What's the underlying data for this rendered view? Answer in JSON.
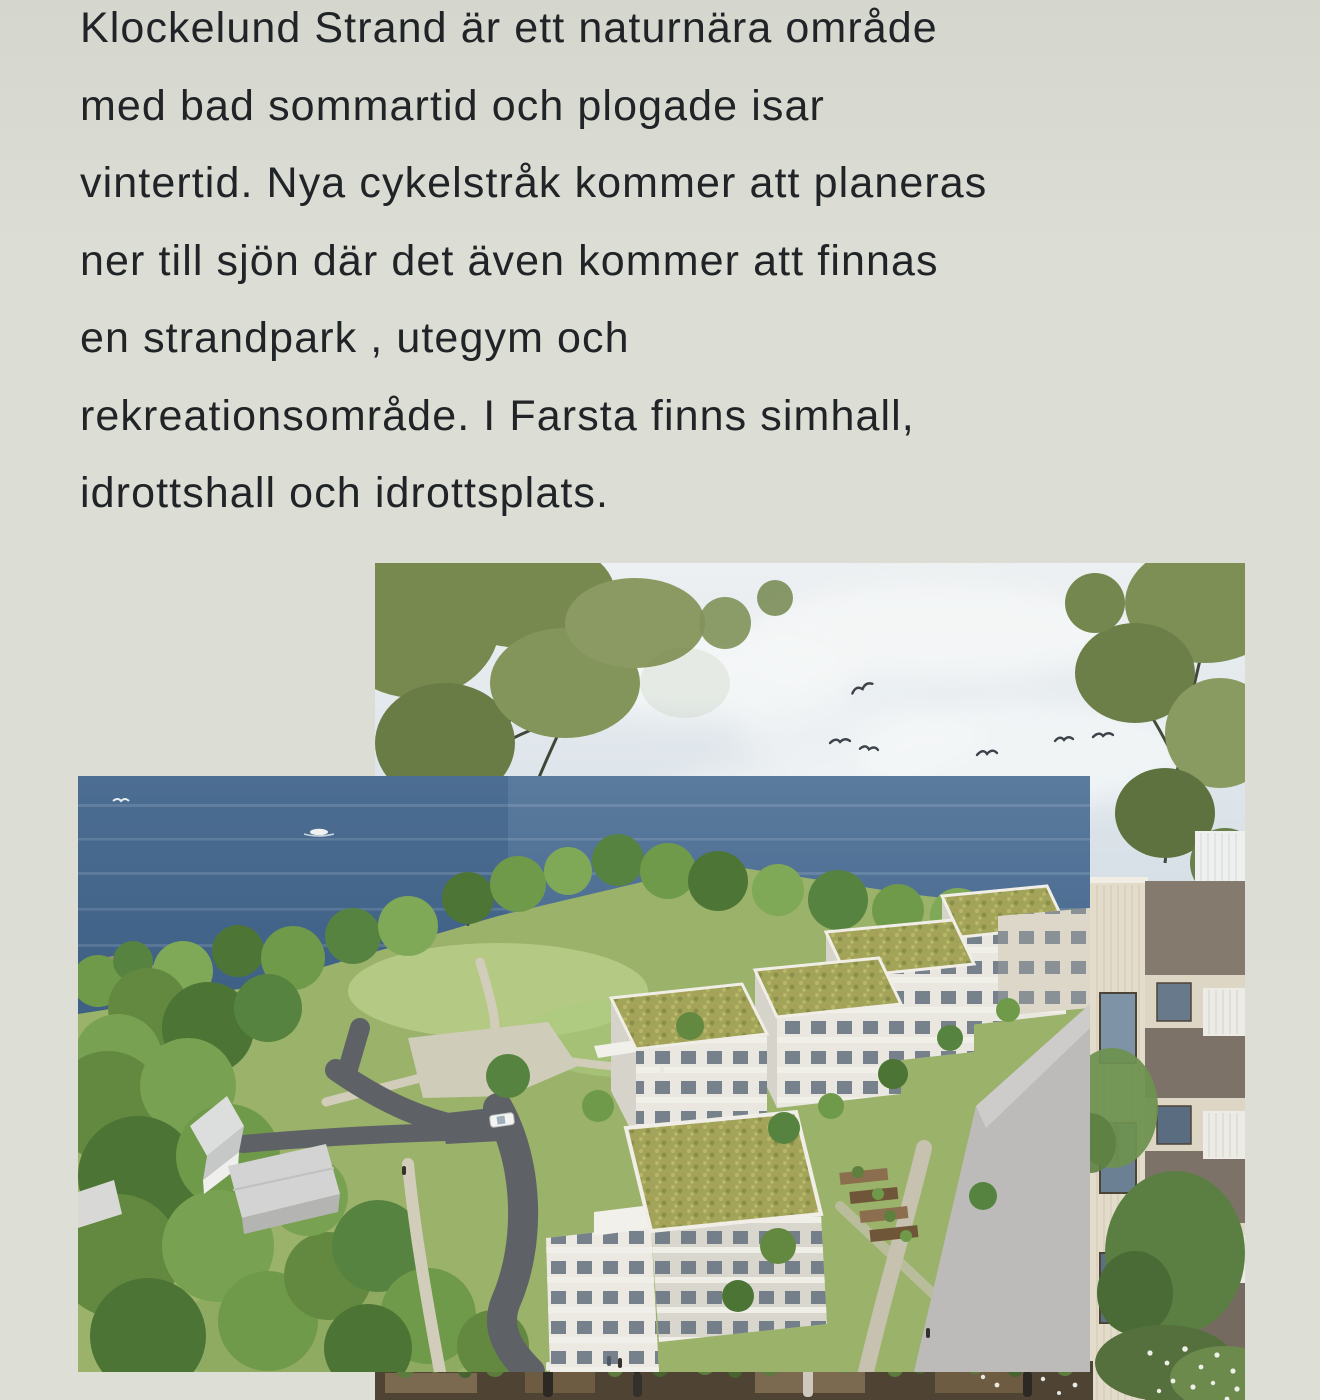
{
  "article": {
    "lines": [
      "Klockelund Strand är ett naturnära område",
      "med bad sommartid och plogade isar",
      "vintertid. Nya cykelstråk kommer att planeras",
      "ner till sjön där det även kommer att finnas",
      "en strandpark , utegym och",
      "rekreationsområde. I Farsta finns simhall,",
      "idrottshall och idrottsplats."
    ]
  },
  "images": {
    "hero": {
      "alt": "Rendering: trees and sky with birds over a lake, close-up of a timber-clad apartment facade with balconies and a planted terrace"
    },
    "aerial": {
      "alt": "Aerial rendering: lakefront park with shoreline trees, paths, roads and white apartment blocks with green sedum roofs"
    }
  },
  "palette": {
    "page_background": "#dcded6",
    "text_color": "#212427",
    "water": "#4e6f93",
    "foliage": "#6f9a49",
    "grass": "#9ab269",
    "sedum_roof": "#a2a45a",
    "facade_white": "#e9e7e0",
    "facade_cream": "#e3dccb",
    "facade_taupe": "#80756a",
    "asphalt": "#5e6266",
    "gravel": "#d0ccba",
    "sky": "#dbe4ea"
  }
}
